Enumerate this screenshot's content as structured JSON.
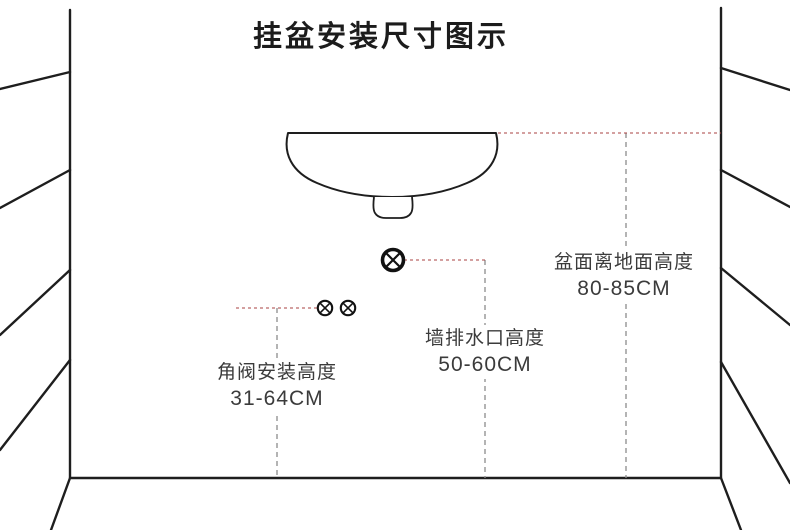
{
  "title": "挂盆安装尺寸图示",
  "annotations": {
    "basin_height": {
      "label": "盆面离地面高度",
      "value": "80-85CM"
    },
    "drain_height": {
      "label": "墙排水口高度",
      "value": "50-60CM"
    },
    "valve_height": {
      "label": "角阀安装高度",
      "value": "31-64CM"
    }
  },
  "symbols": {
    "wall_drain_outlet": "circle-x-icon-large",
    "angle_valve_pair": "circle-x-icon-small"
  },
  "colors": {
    "line": "#1e1e1e",
    "dimension_dash_gray": "#8c8c8c",
    "dimension_dash_red": "#a84040",
    "text": "#3b3b3b",
    "background": "#ffffff"
  }
}
